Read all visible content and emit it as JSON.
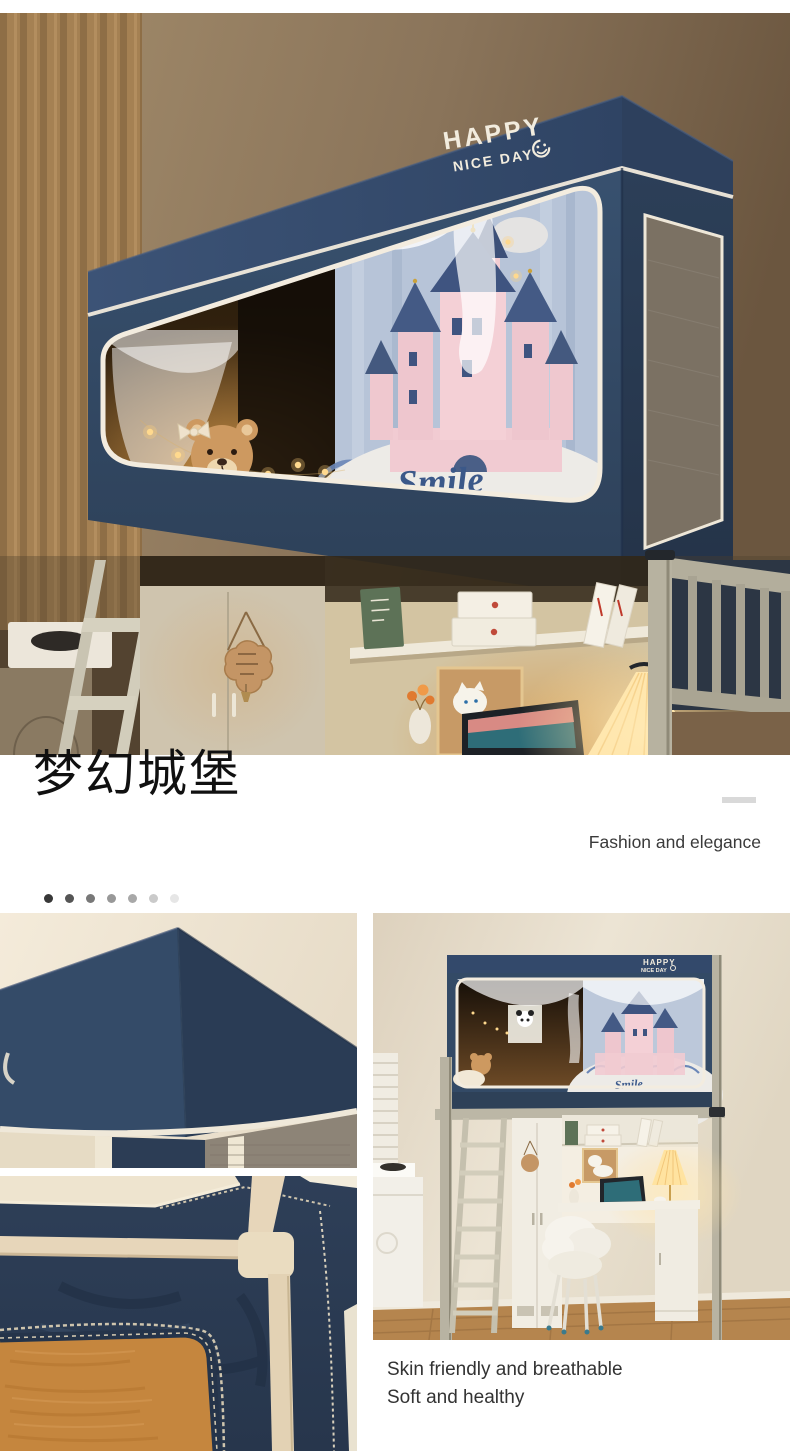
{
  "hero": {
    "logo": {
      "line1": "HAPPY",
      "line2": "NICE DAY"
    },
    "curtain_text": "Smile"
  },
  "title_section": {
    "heading": "梦幻城堡",
    "subtitle": "Fashion and elegance"
  },
  "pagination": {
    "dot_colors": [
      "#383838",
      "#555555",
      "#787878",
      "#989898",
      "#a8a8a8",
      "#cacaca",
      "#e6e6e6"
    ]
  },
  "gallery": {
    "mini": {
      "logo_line1": "HAPPY",
      "logo_line2": "NICE DAY",
      "curtain_text": "Smile"
    },
    "caption": {
      "line1": "Skin friendly and breathable",
      "line2": "Soft and healthy"
    }
  },
  "colors": {
    "navy": "#33496b",
    "navy_dark": "#2a3c55",
    "piping": "#f0e9db",
    "accent_dash": "#d9d9d9"
  }
}
